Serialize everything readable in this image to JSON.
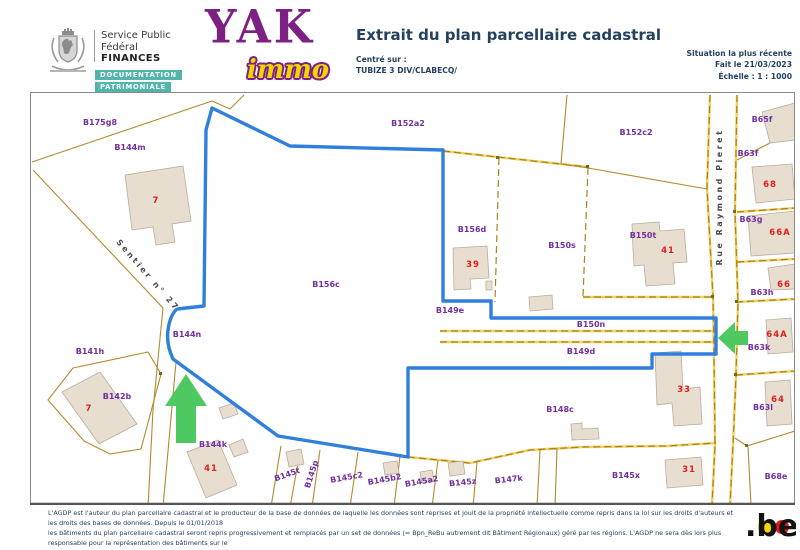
{
  "header": {
    "agency": {
      "line1": "Service Public",
      "line2": "Fédéral",
      "line3": "FINANCES",
      "badge1": "DOCUMENTATION",
      "badge2": "PATRIMONIALE"
    },
    "logo": {
      "brand": "YAK",
      "sub": "immo"
    },
    "title": "Extrait du plan parcellaire cadastral",
    "centered_label": "Centré sur :",
    "centered_value": "TUBIZE 3 DIV/CLABECQ/",
    "meta": [
      "Situation la plus récente",
      "Fait le 21/03/2023",
      "Échelle : 1 : 1000"
    ]
  },
  "map": {
    "streets": [
      {
        "t": "Sentier n° 27",
        "x": 146,
        "y": 277,
        "r": 49
      },
      {
        "t": "Rue Raymond Pieret",
        "x": 722,
        "y": 197,
        "r": -90
      }
    ],
    "parcels": [
      {
        "t": "B175g8",
        "x": 100,
        "y": 125,
        "r": 0
      },
      {
        "t": "B144m",
        "x": 130,
        "y": 150,
        "r": 0
      },
      {
        "t": "B152a2",
        "x": 408,
        "y": 126,
        "r": 0
      },
      {
        "t": "B152c2",
        "x": 636,
        "y": 135,
        "r": 0
      },
      {
        "t": "B65f",
        "x": 762,
        "y": 122,
        "r": 0
      },
      {
        "t": "B63f",
        "x": 748,
        "y": 156,
        "r": 0
      },
      {
        "t": "B156d",
        "x": 472,
        "y": 232,
        "r": 0
      },
      {
        "t": "B150s",
        "x": 562,
        "y": 248,
        "r": 0
      },
      {
        "t": "B150t",
        "x": 643,
        "y": 238,
        "r": 0
      },
      {
        "t": "B63g",
        "x": 751,
        "y": 222,
        "r": 0
      },
      {
        "t": "B63h",
        "x": 762,
        "y": 295,
        "r": 0
      },
      {
        "t": "B63k",
        "x": 759,
        "y": 350,
        "r": 0
      },
      {
        "t": "B63l",
        "x": 763,
        "y": 410,
        "r": 0
      },
      {
        "t": "B68e",
        "x": 776,
        "y": 479,
        "r": 0
      },
      {
        "t": "B144n",
        "x": 187,
        "y": 337,
        "r": 0
      },
      {
        "t": "B156c",
        "x": 326,
        "y": 287,
        "r": 0
      },
      {
        "t": "B149e",
        "x": 450,
        "y": 313,
        "r": 0
      },
      {
        "t": "B150n",
        "x": 591,
        "y": 327,
        "r": 0
      },
      {
        "t": "B149d",
        "x": 581,
        "y": 354,
        "r": 0
      },
      {
        "t": "B141h",
        "x": 90,
        "y": 354,
        "r": 0
      },
      {
        "t": "B142b",
        "x": 117,
        "y": 399,
        "r": 0
      },
      {
        "t": "B144k",
        "x": 213,
        "y": 447,
        "r": 0
      },
      {
        "t": "B145t",
        "x": 288,
        "y": 477,
        "r": -20
      },
      {
        "t": "B145p",
        "x": 314,
        "y": 475,
        "r": -72
      },
      {
        "t": "B145c2",
        "x": 347,
        "y": 480,
        "r": -10
      },
      {
        "t": "B145b2",
        "x": 385,
        "y": 482,
        "r": -10
      },
      {
        "t": "B145a2",
        "x": 422,
        "y": 484,
        "r": -10
      },
      {
        "t": "B145z",
        "x": 463,
        "y": 485,
        "r": -6
      },
      {
        "t": "B147k",
        "x": 509,
        "y": 482,
        "r": -6
      },
      {
        "t": "B148c",
        "x": 560,
        "y": 412,
        "r": 0
      },
      {
        "t": "B145x",
        "x": 626,
        "y": 478,
        "r": 0
      }
    ],
    "house_numbers": [
      {
        "t": "7",
        "x": 156,
        "y": 203
      },
      {
        "t": "7",
        "x": 89,
        "y": 411
      },
      {
        "t": "39",
        "x": 473,
        "y": 267
      },
      {
        "t": "41",
        "x": 668,
        "y": 253
      },
      {
        "t": "41",
        "x": 211,
        "y": 471
      },
      {
        "t": "68",
        "x": 770,
        "y": 187
      },
      {
        "t": "66A",
        "x": 780,
        "y": 235
      },
      {
        "t": "66",
        "x": 784,
        "y": 287
      },
      {
        "t": "64A",
        "x": 777,
        "y": 337
      },
      {
        "t": "64",
        "x": 778,
        "y": 402
      },
      {
        "t": "33",
        "x": 684,
        "y": 392
      },
      {
        "t": "31",
        "x": 689,
        "y": 472
      }
    ],
    "colors": {
      "highlight_blue": "#2f7fdd",
      "arrow_green": "#4ec860",
      "parcel_label_purple": "#7130a0",
      "house_number_red": "#dd2020",
      "boundary_tan": "#b5892e",
      "building_fill": "#e7decf"
    }
  },
  "footer": {
    "lines": [
      "L'AGDP est l'auteur du plan parcellaire cadastral et le producteur de la base de données de laquelle les données sont reprises et jouit de la propriété intellectuelle comme repris dans la loi sur les droits d'auteurs et les droits des bases de données. Depuis le 01/01/2018",
      "les bâtiments du plan parcellaire cadastral seront repris progressivement et remplacés par un set de données (= Bpn_ReBu autrement dit Bâtiment Régionaux) géré par les régions. L'AGDP ne sera dès lors plus responsable pour la représentation des bâtiments sur le",
      "plan parcellaire cadastral."
    ],
    "logo": ".be"
  }
}
